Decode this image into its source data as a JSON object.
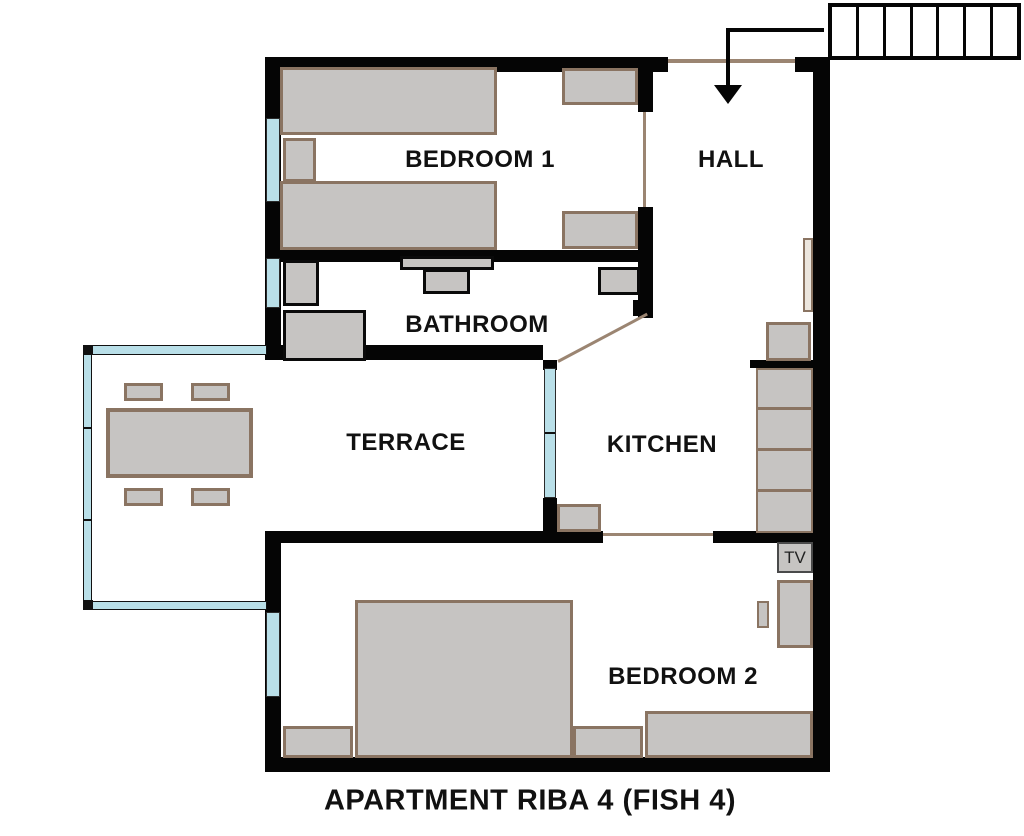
{
  "title": "APARTMENT RIBA 4 (FISH 4)",
  "rooms": {
    "bedroom1": {
      "label": "BEDROOM 1"
    },
    "hall": {
      "label": "HALL"
    },
    "bathroom": {
      "label": "BATHROOM"
    },
    "terrace": {
      "label": "TERRACE"
    },
    "kitchen": {
      "label": "KITCHEN"
    },
    "bedroom2": {
      "label": "BEDROOM 2"
    }
  },
  "furniture": {
    "tv_label": "TV"
  },
  "stairs": {
    "steps": 7
  },
  "colors": {
    "wall": "#050505",
    "furniture_fill": "#c6c4c2",
    "furniture_border": "#8a7462",
    "bathroom_fixture_border": "#0a0a0a",
    "window_glass": "#b9dfe8",
    "door_threshold_line": "#9b8572",
    "label_text": "#111111"
  }
}
